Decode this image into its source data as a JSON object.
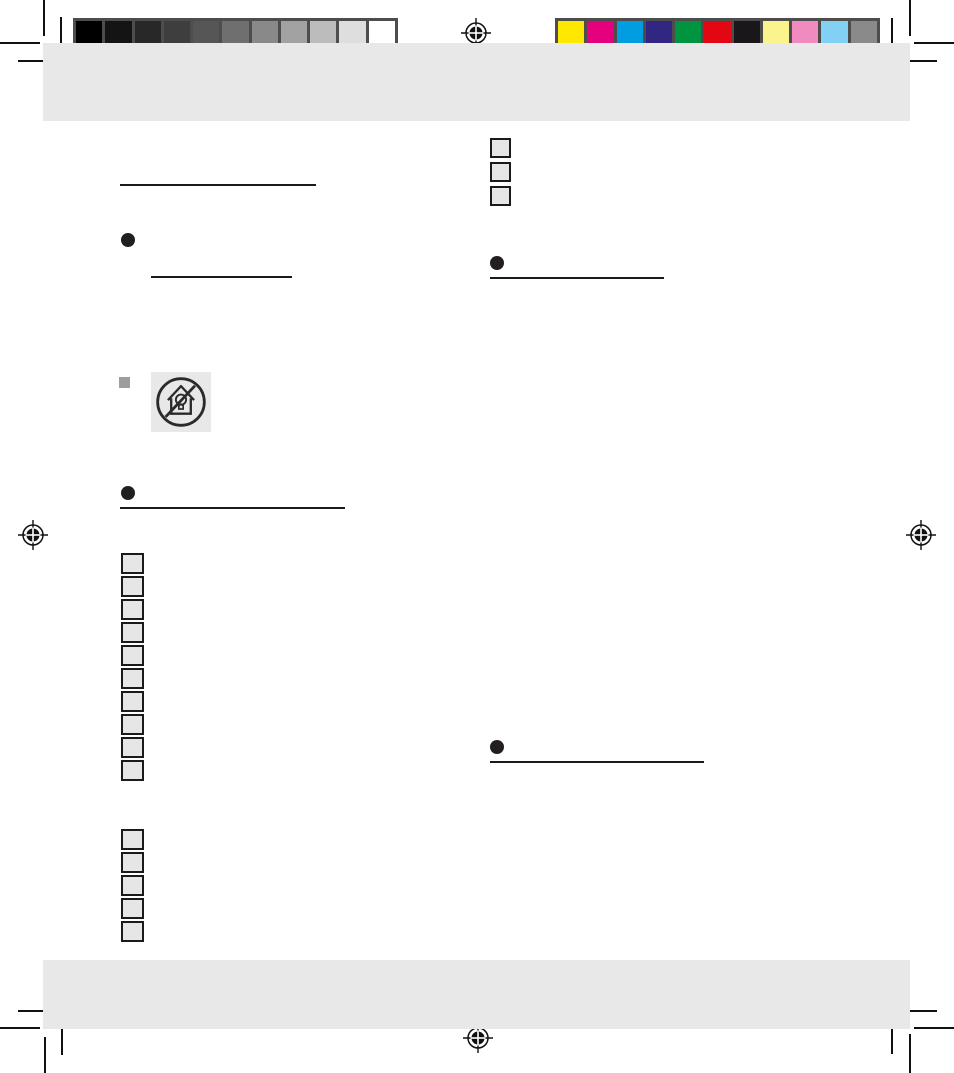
{
  "document": {
    "background": "#ffffff",
    "band_color": "#e8e8e8"
  },
  "calibration": {
    "frame_color": "#4d4d4d",
    "grayscale_swatches": [
      "#000000",
      "#141414",
      "#282828",
      "#3e3e3e",
      "#565656",
      "#6f6f6f",
      "#898989",
      "#a2a2a2",
      "#bcbcbc",
      "#dedede",
      "#ffffff"
    ],
    "color_swatches": [
      "#ffe800",
      "#e5007d",
      "#009ee0",
      "#312782",
      "#009440",
      "#e30613",
      "#1a171b",
      "#fbf38b",
      "#f18bbf",
      "#82d1f5",
      "#8a8a8a"
    ]
  },
  "marks": {
    "mark_color": "#111111",
    "registration_mark_count": 4,
    "crop_mark_corner_count": 4
  },
  "icons": {
    "safety_symbol": "no-household-illumination-icon"
  },
  "placeholders": {
    "right_top_box_count": 3,
    "left_list_box_count": 10,
    "left_list2_box_count": 5,
    "box_fill": "#e6e6e6",
    "box_border": "#1a1a1a",
    "bullet_color": "#231f20",
    "rule_color": "#1a1a1a",
    "square_bullet_color": "#9d9d9d"
  }
}
